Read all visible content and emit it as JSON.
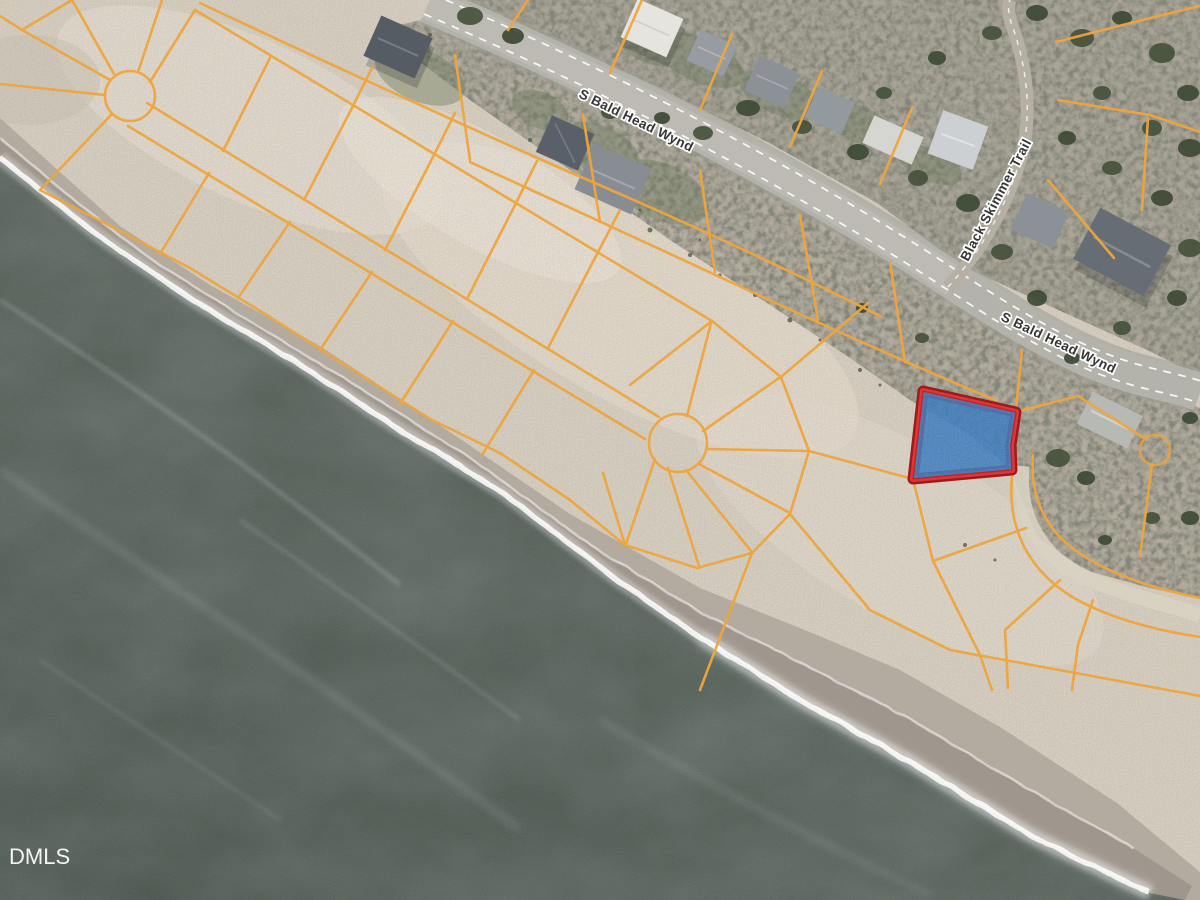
{
  "map": {
    "watermark": "DMLS",
    "road_labels": [
      {
        "text": "S Bald Head Wynd"
      },
      {
        "text": "S Bald Head Wynd"
      },
      {
        "text": "Black Skimmer Trail"
      }
    ],
    "highlighted_parcel": {
      "fill_color": "#4a8fd6",
      "border_color": "#e23636",
      "border_outer_color": "#9c1c1c"
    },
    "palette": {
      "ocean": "#57625b",
      "sand": "#ddd5c6",
      "wet_sand": "#b3aba0",
      "foam": "#ffffff",
      "parcel_line": "#efa53d",
      "road": "#b4b3ab",
      "vegetation": "#8b877b"
    }
  }
}
